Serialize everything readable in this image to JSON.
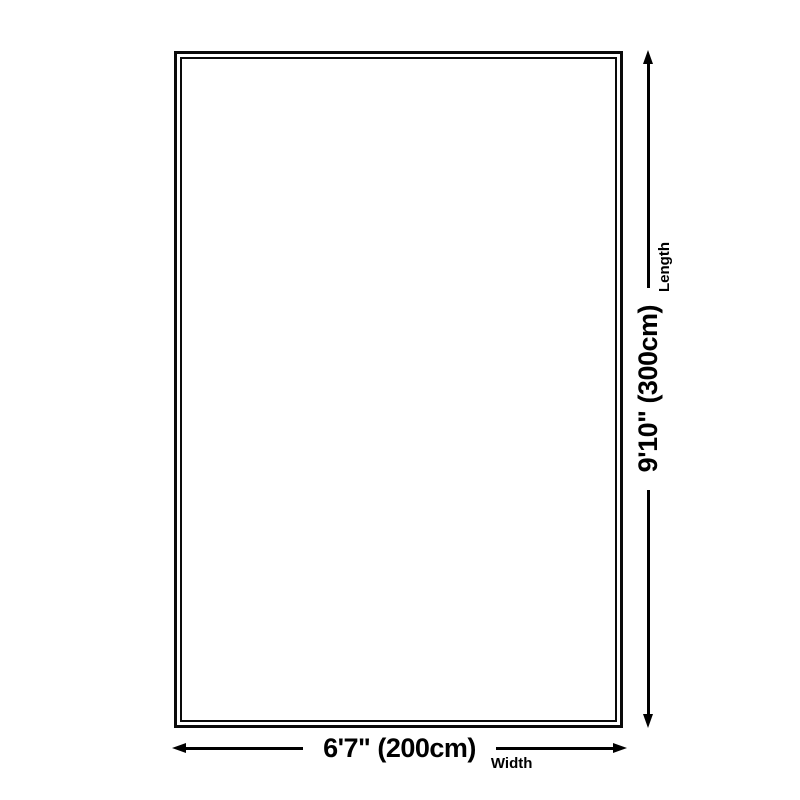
{
  "diagram": {
    "background_color": "#ffffff",
    "line_color": "#000000",
    "rug": {
      "border_style": "double",
      "fill_color": "#ffffff"
    },
    "width_dimension": {
      "value": "6'7\" (200cm)",
      "caption": "Width"
    },
    "length_dimension": {
      "value": "9'10\" (300cm)",
      "caption": "Length"
    }
  }
}
